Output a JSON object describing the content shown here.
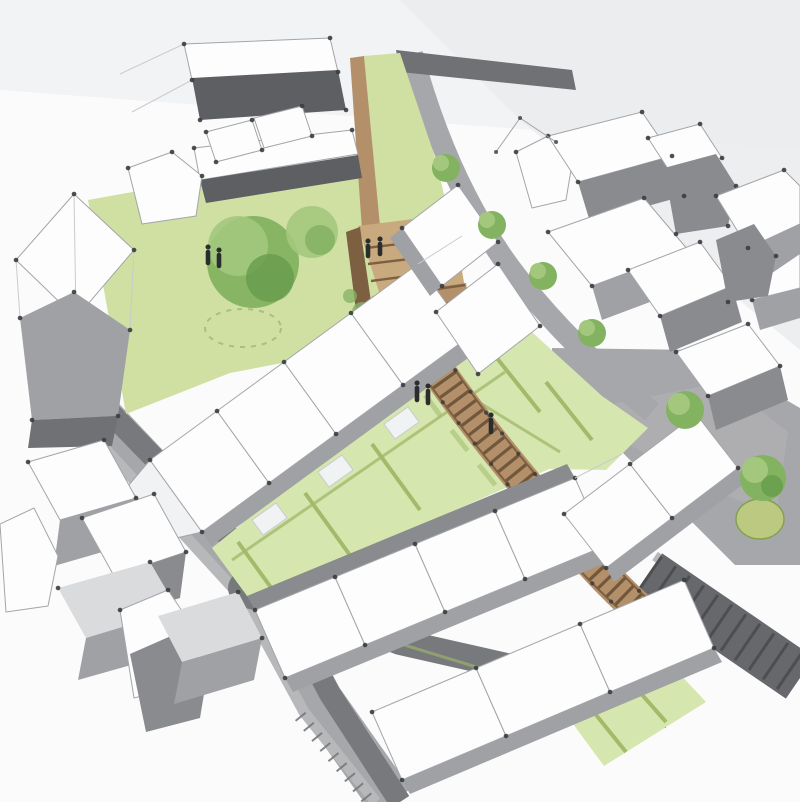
{
  "canvas": {
    "width": 800,
    "height": 802
  },
  "scene": {
    "type": "architectural concept rendering",
    "view": "aerial axonometric sketch",
    "setting": "Housing development massing study with central lawn, timber amphitheatre steps and boardwalk, rows of white terraced houses, hedged gardens, grey streets, a paved plaza with oval planter and striped parking bays",
    "counts": {
      "lawn_trees": 2,
      "street_trees": 4,
      "plaza_trees": 2,
      "people": 7,
      "terrace_rows": 5
    },
    "materials": {
      "houses": "white massing with grey shaded faces and corner nodes",
      "walkway": "timber decking with cross planks and edge posts",
      "ground": "lawn and hedged garden plots",
      "streets": "grey asphalt with light kerbs and hatched crossings"
    }
  },
  "palette": {
    "bg": "#fbfbfc",
    "wash": "#eaebed",
    "washsoft": "#f2f3f4",
    "white": "#fdfdfe",
    "whitedim": "#f1f2f3",
    "linelight": "#c9cbcd",
    "linemid": "#a3a5a8",
    "ink": "#3a3c3e",
    "facelight": "#d9dbdd",
    "facemid": "#9fa1a4",
    "facedark": "#898b8e",
    "facedarker": "#6f7174",
    "band": "#5d5f62",
    "roadlight": "#b7b8ba",
    "roadmid": "#a6a7aa",
    "roaddark": "#818386",
    "roadcore": "#77797c",
    "lawn": "#cfe0a2",
    "lawnsoft": "#dde9bd",
    "garden": "#d6e6af",
    "hedge": "#a3ba6b",
    "hedgedark": "#86a050",
    "treedark": "#699e4d",
    "treemid": "#83b261",
    "treelight": "#a3c87d",
    "timber": "#b3906a",
    "timberlight": "#c9aa7e",
    "timberdark": "#7d5f41",
    "timberdeep": "#60492f",
    "planter": "#bcca81",
    "figure": "#2b2c2e",
    "parking": "#66686b",
    "stripe": "#4c4e50"
  }
}
